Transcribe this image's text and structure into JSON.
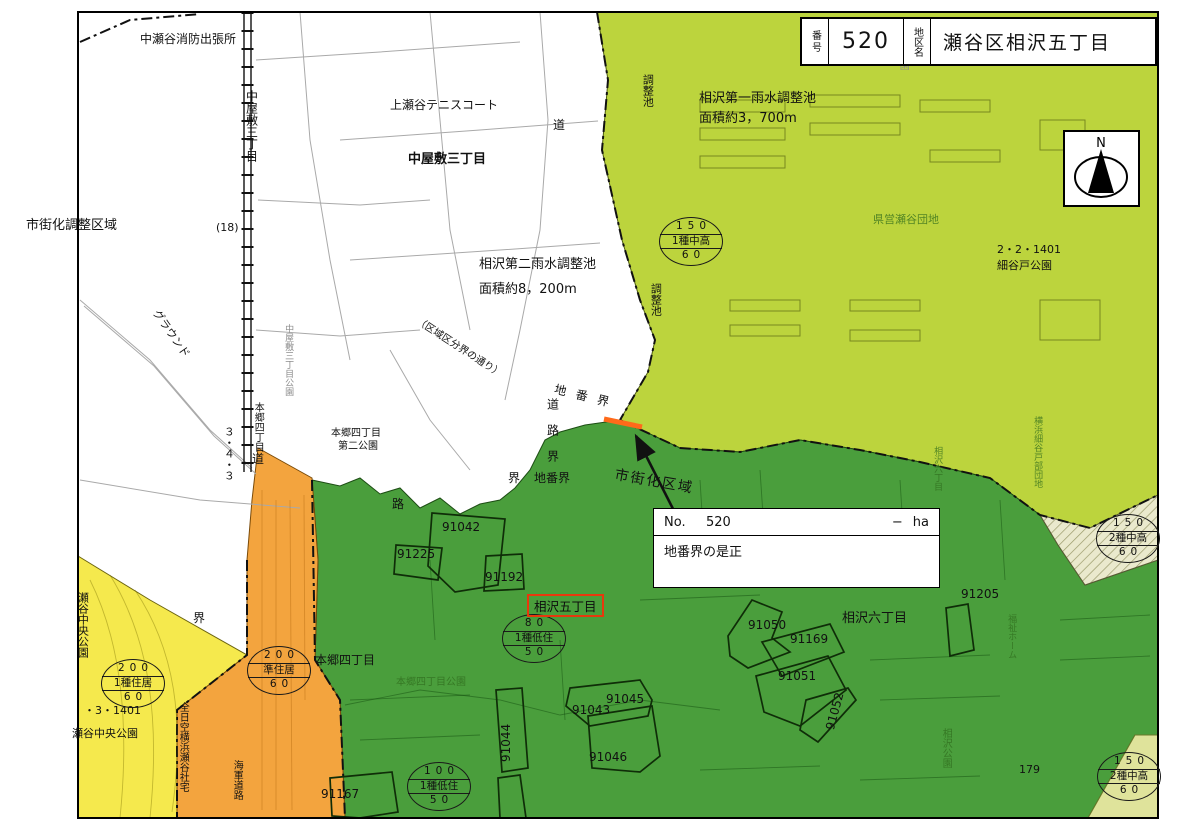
{
  "colors": {
    "lightgreen": "#bcd43d",
    "darkgreen": "#4a9e3c",
    "yellow": "#f5e94d",
    "orange": "#f3a43e",
    "palegreen": "#dfe39b",
    "cream": "#eae9cd",
    "red": "#e8380d",
    "highlight_orange": "#ff6a1a"
  },
  "title_block": {
    "no_label": "番号",
    "no_value": "520",
    "district_label": "地区名",
    "district_value": "瀬谷区相沢五丁目"
  },
  "north_label": "N",
  "info_box": {
    "no_label": "No.",
    "no_value": "520",
    "dash": "−",
    "unit": "ha",
    "note": "地番界の是正"
  },
  "highlight_label": "相沢五丁目",
  "zone_badges": [
    {
      "name": "zone-badge-150-1chuko",
      "top": "150",
      "mid": "1種中高",
      "bot": "60",
      "x": 690,
      "y": 243
    },
    {
      "name": "zone-badge-150-2chuko-right",
      "top": "150",
      "mid": "2種中高",
      "bot": "60",
      "x": 1127,
      "y": 540
    },
    {
      "name": "zone-badge-150-2chuko-bottom",
      "top": "150",
      "mid": "2種中高",
      "bot": "60",
      "x": 1128,
      "y": 778
    },
    {
      "name": "zone-badge-80-1teiju",
      "top": "80",
      "mid": "1種低住",
      "bot": "50",
      "x": 533,
      "y": 640
    },
    {
      "name": "zone-badge-100-1teiju",
      "top": "100",
      "mid": "1種低住",
      "bot": "50",
      "x": 438,
      "y": 788
    },
    {
      "name": "zone-badge-200-junjukyo",
      "top": "200",
      "mid": "準住居",
      "bot": "60",
      "x": 278,
      "y": 672
    },
    {
      "name": "zone-badge-200-1jukyo",
      "top": "200",
      "mid": "1種住居",
      "bot": "60",
      "x": 132,
      "y": 685
    }
  ],
  "map_labels": [
    {
      "n": "fire-station-label",
      "t": "中瀬谷消防出張所",
      "x": 140,
      "y": 33,
      "s": 12
    },
    {
      "n": "nakayashiki-3chome-vertical-label",
      "t": "中屋敷三丁目",
      "x": 244,
      "y": 90,
      "m": "v",
      "s": 12
    },
    {
      "n": "kamiseya-tennis-court-label",
      "t": "上瀬谷テニスコート",
      "x": 390,
      "y": 99,
      "s": 12
    },
    {
      "n": "nakayashiki-3chome-label",
      "t": "中屋敷三丁目",
      "x": 408,
      "y": 153,
      "s": 13,
      "c": "bold"
    },
    {
      "n": "urbanization-control-area-label",
      "t": "市街化調整区域",
      "x": 26,
      "y": 219,
      "s": 13
    },
    {
      "n": "route-18-label",
      "t": "(18)",
      "x": 216,
      "y": 222,
      "s": 11
    },
    {
      "n": "road-3-4-3-label",
      "t": "３・４・３",
      "x": 222,
      "y": 426,
      "m": "v",
      "s": 11
    },
    {
      "n": "ground-label",
      "t": "グラウンド",
      "x": 160,
      "y": 308,
      "m": "r55",
      "s": 11
    },
    {
      "n": "reservoir2-name-label",
      "t": "相沢第二雨水調整池",
      "x": 479,
      "y": 258,
      "s": 13
    },
    {
      "n": "reservoir2-area-label",
      "t": "面積約8，200m",
      "x": 479,
      "y": 283,
      "s": 13
    },
    {
      "n": "kuiki-kubun-street-label",
      "t": "（区域区分界の通り）",
      "x": 420,
      "y": 316,
      "m": "r33",
      "s": 10
    },
    {
      "n": "nakayashiki-park-label",
      "t": "中屋敷三丁目公園",
      "x": 283,
      "y": 324,
      "m": "v",
      "s": 9,
      "c": "faint"
    },
    {
      "n": "hongo-4chome-vertical-label",
      "t": "本郷四丁目",
      "x": 252,
      "y": 402,
      "m": "v",
      "s": 10
    },
    {
      "n": "hongo-4chome-park2-line1",
      "t": "本郷四丁目",
      "x": 331,
      "y": 428,
      "s": 10
    },
    {
      "n": "hongo-4chome-park2-line2",
      "t": "第二公園",
      "x": 338,
      "y": 441,
      "s": 10
    },
    {
      "n": "road-kanji-top",
      "t": "道",
      "x": 553,
      "y": 119,
      "s": 12
    },
    {
      "n": "chibankai-diagonal-label",
      "t": "地番界",
      "x": 556,
      "y": 383,
      "m": "r14",
      "s": 12,
      "ls": 10
    },
    {
      "n": "dourokai-vertical-label",
      "t": "道路界",
      "x": 545,
      "y": 398,
      "m": "v",
      "s": 12,
      "ls": 14
    },
    {
      "n": "kai-label-west",
      "t": "界",
      "x": 508,
      "y": 472,
      "s": 12
    },
    {
      "n": "chibankai-label-south",
      "t": "地番界",
      "x": 534,
      "y": 472,
      "s": 12
    },
    {
      "n": "road-kanji-mid",
      "t": "道",
      "x": 252,
      "y": 453,
      "s": 12
    },
    {
      "n": "ro-kanji-mid",
      "t": "路",
      "x": 392,
      "y": 498,
      "s": 12
    },
    {
      "n": "chosei-ike-north-label",
      "t": "調整池",
      "x": 641,
      "y": 74,
      "m": "v",
      "s": 11
    },
    {
      "n": "reservoir1-name-label",
      "t": "相沢第一雨水調整池",
      "x": 699,
      "y": 92,
      "s": 13
    },
    {
      "n": "reservoir1-area-label",
      "t": "面積約3，700m",
      "x": 699,
      "y": 112,
      "s": 13
    },
    {
      "n": "hoikuen-partial-label",
      "t": "育園",
      "x": 897,
      "y": 50,
      "m": "v",
      "s": 10,
      "c": "faint"
    },
    {
      "n": "kenei-seya-danchi-label",
      "t": "県営瀬谷団地",
      "x": 873,
      "y": 214,
      "s": 11,
      "c": "fgreen"
    },
    {
      "n": "code-2-2-1401-label",
      "t": "2・2・1401",
      "x": 997,
      "y": 244,
      "s": 11
    },
    {
      "n": "hosoyado-park-label",
      "t": "細谷戸公園",
      "x": 997,
      "y": 260,
      "s": 11
    },
    {
      "n": "yokohama-hosoyado-danchi-label",
      "t": "横浜細谷戸部団地",
      "x": 1032,
      "y": 416,
      "m": "v",
      "s": 9,
      "c": "fgreen"
    },
    {
      "n": "aizawa-6chome-vertical-label",
      "t": "相沢六丁目",
      "x": 932,
      "y": 446,
      "m": "v",
      "s": 9,
      "c": "fgreen"
    },
    {
      "n": "chosei-ike-mid-label",
      "t": "調整池",
      "x": 649,
      "y": 283,
      "m": "v",
      "s": 11
    },
    {
      "n": "urbanization-area-label",
      "t": "市街化区域",
      "x": 616,
      "y": 468,
      "m": "r10",
      "s": 14,
      "ls": 2
    },
    {
      "n": "parcel-91042-label",
      "t": "91042",
      "x": 442,
      "y": 521,
      "s": 12
    },
    {
      "n": "parcel-91225-label",
      "t": "91225",
      "x": 397,
      "y": 548,
      "s": 12
    },
    {
      "n": "parcel-91192-label",
      "t": "91192",
      "x": 485,
      "y": 571,
      "s": 12
    },
    {
      "n": "hongo-4chome-label",
      "t": "本郷四丁目",
      "x": 315,
      "y": 654,
      "s": 12
    },
    {
      "n": "hongo-4chome-park-label",
      "t": "本郷四丁目公園",
      "x": 396,
      "y": 677,
      "s": 10,
      "c": "fgreen"
    },
    {
      "n": "parcel-91050-label",
      "t": "91050",
      "x": 748,
      "y": 619,
      "s": 12
    },
    {
      "n": "aizawa-6chome-label",
      "t": "相沢六丁目",
      "x": 842,
      "y": 612,
      "s": 13
    },
    {
      "n": "parcel-91169-label",
      "t": "91169",
      "x": 790,
      "y": 633,
      "s": 12
    },
    {
      "n": "parcel-91051-label",
      "t": "91051",
      "x": 778,
      "y": 670,
      "s": 12
    },
    {
      "n": "parcel-91052-label",
      "t": "91052",
      "x": 824,
      "y": 728,
      "m": "r-75",
      "s": 12
    },
    {
      "n": "parcel-91205-label",
      "t": "91205",
      "x": 961,
      "y": 588,
      "s": 12
    },
    {
      "n": "parcel-91044-label",
      "t": "91044",
      "x": 500,
      "y": 762,
      "m": "r-90",
      "s": 12
    },
    {
      "n": "parcel-91043-label",
      "t": "91043",
      "x": 572,
      "y": 704,
      "s": 12
    },
    {
      "n": "parcel-91045-label",
      "t": "91045",
      "x": 606,
      "y": 693,
      "s": 12
    },
    {
      "n": "parcel-91046-label",
      "t": "91046",
      "x": 589,
      "y": 751,
      "s": 12
    },
    {
      "n": "parcel-91167-label",
      "t": "91167",
      "x": 321,
      "y": 788,
      "s": 12
    },
    {
      "n": "fukushi-home-label",
      "t": "福祉ホーム",
      "x": 1006,
      "y": 614,
      "m": "v",
      "s": 9,
      "c": "fgreen"
    },
    {
      "n": "aizawa-park-label",
      "t": "相沢公園",
      "x": 940,
      "y": 728,
      "m": "v",
      "s": 10,
      "c": "fgreen"
    },
    {
      "n": "parcel-179-label",
      "t": "179",
      "x": 1019,
      "y": 764,
      "s": 11
    },
    {
      "n": "seya-chuo-park-vertical-label",
      "t": "瀬谷中央公園",
      "x": 76,
      "y": 592,
      "m": "v",
      "s": 11
    },
    {
      "n": "code-3-1401-label",
      "t": "・3・1401",
      "x": 84,
      "y": 705,
      "s": 11
    },
    {
      "n": "seya-chuo-park-label",
      "t": "瀬谷中央公園",
      "x": 72,
      "y": 728,
      "s": 11
    },
    {
      "n": "ana-yokohama-seya-shataku-label",
      "t": "全日空横浜瀬谷社宅",
      "x": 177,
      "y": 702,
      "m": "v",
      "s": 10
    },
    {
      "n": "kaigun-doro-label",
      "t": "海軍道路",
      "x": 231,
      "y": 760,
      "m": "v",
      "s": 10
    },
    {
      "n": "kai-label-left",
      "t": "界",
      "x": 193,
      "y": 612,
      "s": 12
    }
  ]
}
